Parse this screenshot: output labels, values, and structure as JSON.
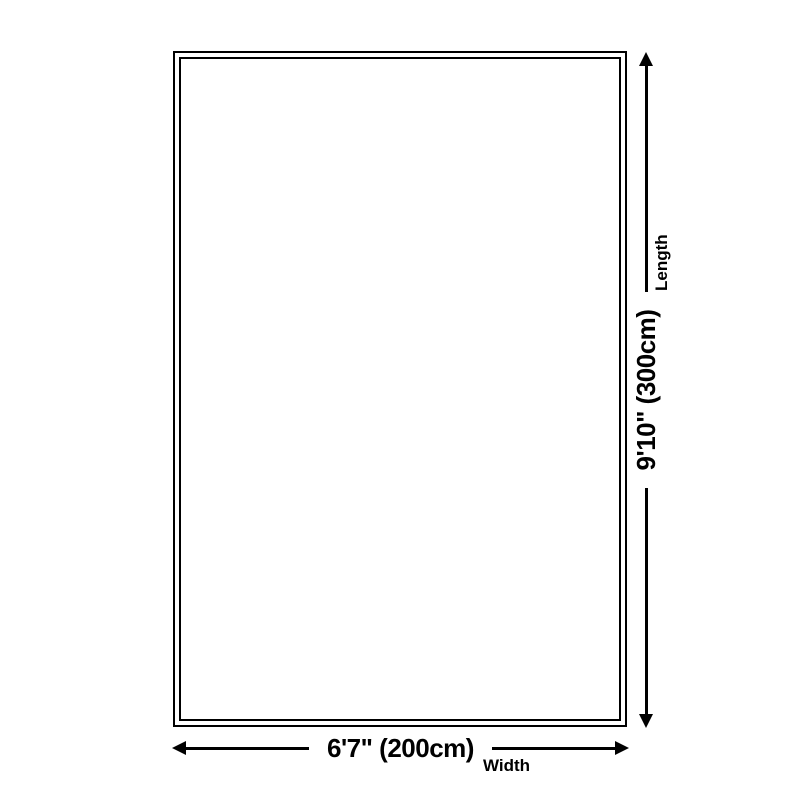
{
  "diagram": {
    "background_color": "#ffffff",
    "line_color": "#000000",
    "shape": "rectangle-double-border",
    "width_dimension": {
      "value": "6'7\" (200cm)",
      "label": "Width"
    },
    "length_dimension": {
      "value": "9'10\" (300cm)",
      "label": "Length"
    }
  }
}
